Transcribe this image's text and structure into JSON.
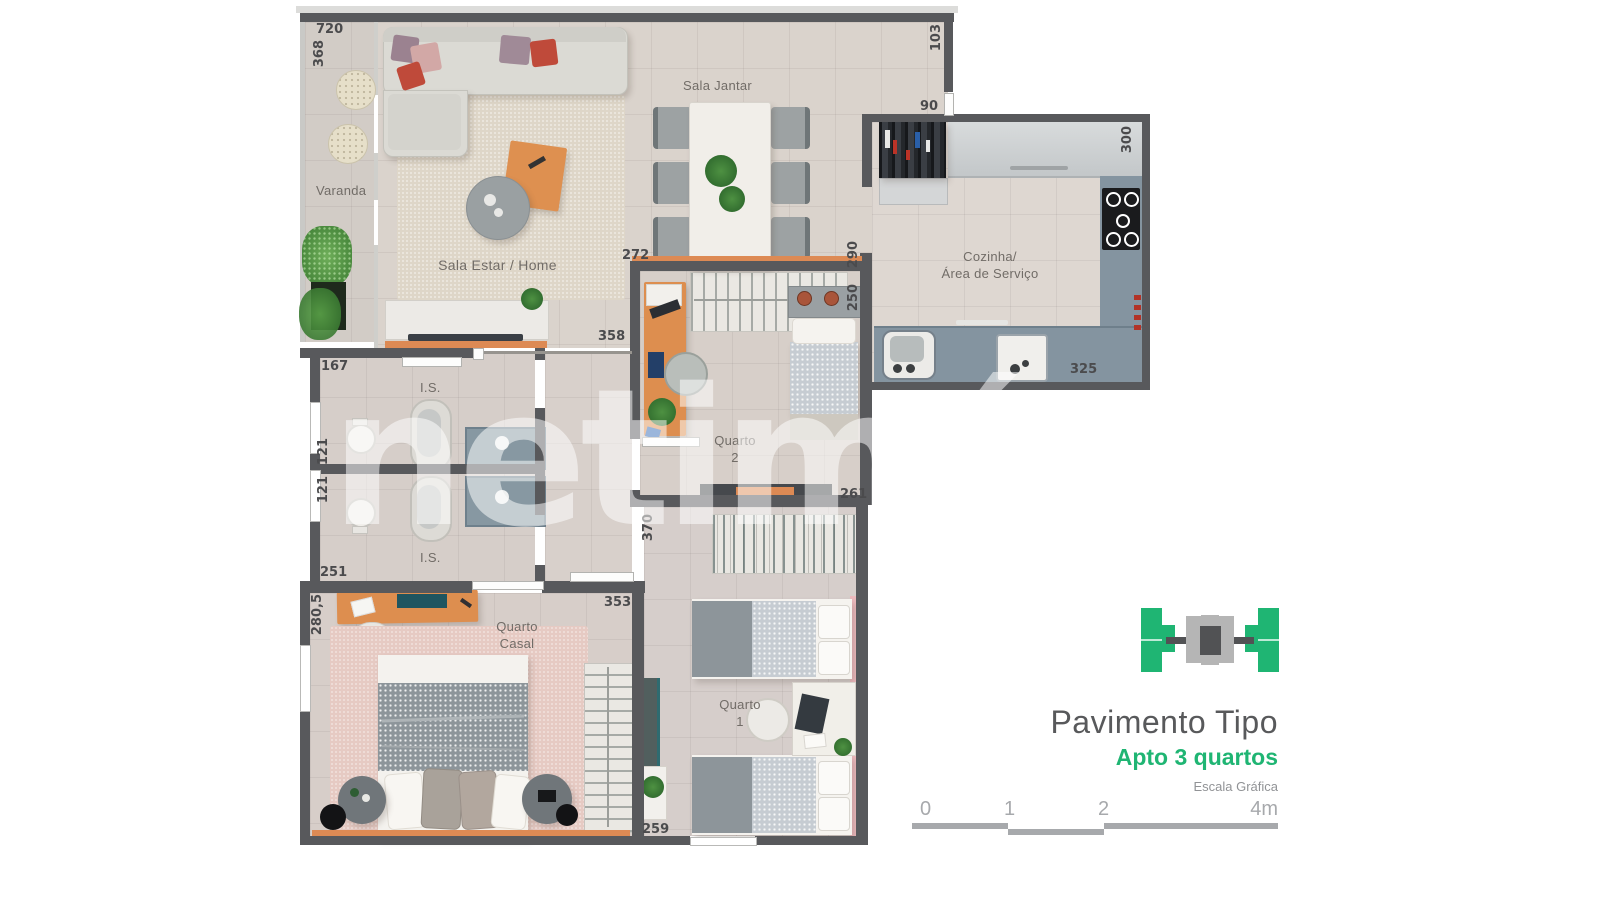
{
  "watermark_text": "netimóveis",
  "rooms": {
    "varanda": "Varanda",
    "sala_estar": "Sala Estar / Home",
    "sala_jantar": "Sala Jantar",
    "cozinha_l1": "Cozinha/",
    "cozinha_l2": "Área de Serviço",
    "is_top": "I.S.",
    "is_bottom": "I.S.",
    "quarto2_l1": "Quarto",
    "quarto2_l2": "2",
    "quarto_casal_l1": "Quarto",
    "quarto_casal_l2": "Casal",
    "quarto1_l1": "Quarto",
    "quarto1_l2": "1"
  },
  "dimensions": {
    "d720": "720",
    "d368": "368",
    "d103": "103",
    "d90": "90",
    "d300": "300",
    "d272": "272",
    "d290": "290",
    "d250": "250",
    "d358": "358",
    "d167": "167",
    "d121a": "121",
    "d121b": "121",
    "d251": "251",
    "d280_5": "280,5",
    "d353": "353",
    "d370": "370",
    "d261": "261",
    "d259": "259",
    "d325": "325"
  },
  "legend": {
    "title": "Pavimento Tipo",
    "subtitle": "Apto 3 quartos",
    "scale_label": "Escala Gráfica",
    "scale_ticks": [
      "0",
      "1",
      "2",
      "4m"
    ],
    "colors": {
      "green": "#1fb573",
      "dark_gray": "#58595b",
      "light_gray": "#a7a9ac"
    }
  }
}
